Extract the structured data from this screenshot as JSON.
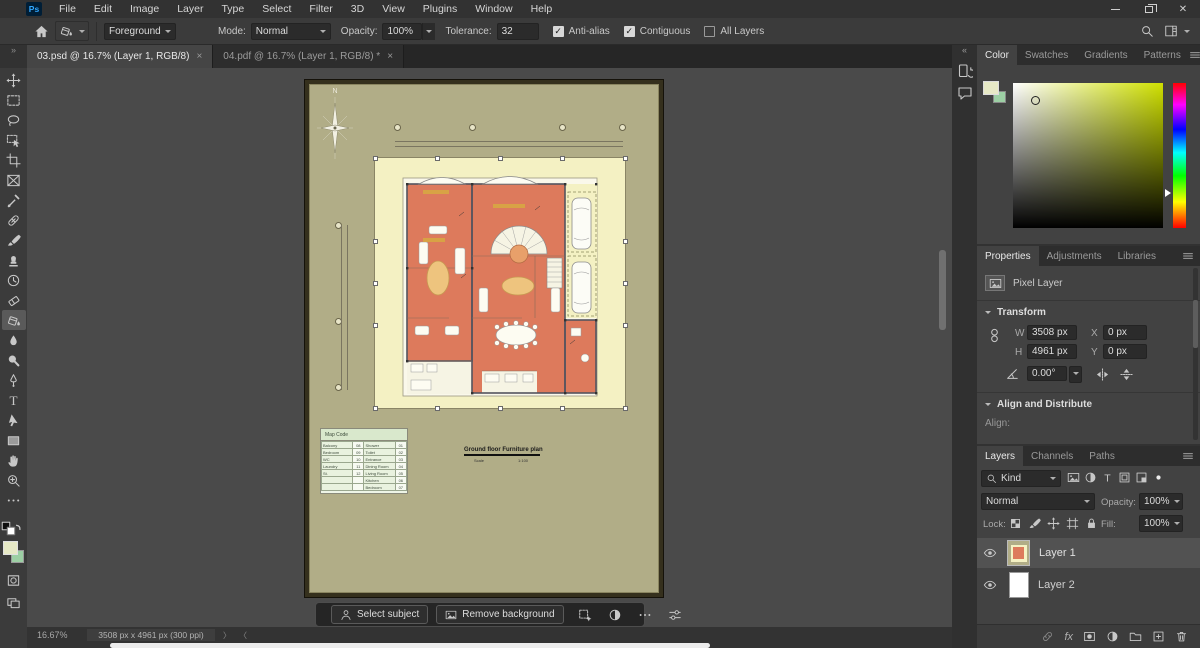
{
  "menu_bar": {
    "logo": "Ps",
    "items": [
      "File",
      "Edit",
      "Image",
      "Layer",
      "Type",
      "Select",
      "Filter",
      "3D",
      "View",
      "Plugins",
      "Window",
      "Help"
    ]
  },
  "window_controls": {
    "close_glyph": "✕"
  },
  "options_bar": {
    "preset_value": "Foreground",
    "mode_label": "Mode:",
    "mode_value": "Normal",
    "opacity_label": "Opacity:",
    "opacity_value": "100%",
    "tolerance_label": "Tolerance:",
    "tolerance_value": "32",
    "check_glyph": "✓",
    "checkboxes": [
      {
        "label": "Anti-alias",
        "checked": true
      },
      {
        "label": "Contiguous",
        "checked": true
      },
      {
        "label": "All Layers",
        "checked": false
      }
    ]
  },
  "tabs": [
    {
      "label": "03.psd @ 16.7% (Layer 1, RGB/8)",
      "close": "×",
      "active": true
    },
    {
      "label": "04.pdf @ 16.7% (Layer 1, RGB/8) *",
      "close": "×",
      "active": false
    }
  ],
  "toolbar": {
    "collapse_glyph": "»",
    "tools": [
      "move",
      "rect-marquee",
      "lasso",
      "object-selection",
      "crop",
      "frame",
      "eyedropper",
      "spot-healing",
      "brush",
      "clone-stamp",
      "history-brush",
      "eraser",
      "paint-bucket",
      "blur",
      "dodge",
      "pen",
      "type",
      "path-selection",
      "rectangle",
      "hand",
      "zoom",
      "edit-toolbar"
    ],
    "selected": "paint-bucket",
    "foreground_color": "#e7e9c6",
    "background_color": "#9ccfa4"
  },
  "document": {
    "compass_label": "N",
    "title": "Ground floor Furniture plan",
    "scale_label": "Scale",
    "scale_value": "1:100",
    "legend": {
      "title": "Map Code",
      "rows": [
        [
          "Balcony",
          "08",
          "Shower",
          "01"
        ],
        [
          "Bedroom",
          "09",
          "Toilet",
          "02"
        ],
        [
          "WC",
          "10",
          "Entrance",
          "03"
        ],
        [
          "Laundry",
          "11",
          "Dining Room",
          "04"
        ],
        [
          "St.",
          "12",
          "Living Room",
          "05"
        ],
        [
          "",
          "",
          "Kitchen",
          "06"
        ],
        [
          "",
          "",
          "Bedroom",
          "07"
        ]
      ]
    },
    "colors": {
      "mat": "#b1ad87",
      "paper": "#f4f1c3",
      "rooms": "#dd7a5c",
      "frame": "#35301d"
    }
  },
  "context_bar": {
    "select_subject": "Select subject",
    "remove_background": "Remove background"
  },
  "dock": {
    "collapse_glyph": "«"
  },
  "panels": {
    "color": {
      "tabs": [
        "Color",
        "Swatches",
        "Gradients",
        "Patterns"
      ],
      "active_tab": "Color"
    },
    "properties": {
      "tabs": [
        "Properties",
        "Adjustments",
        "Libraries"
      ],
      "active_tab": "Properties",
      "layer_type": "Pixel Layer",
      "transform": {
        "header": "Transform",
        "w_label": "W",
        "w_value": "3508 px",
        "x_label": "X",
        "x_value": "0 px",
        "h_label": "H",
        "h_value": "4961 px",
        "y_label": "Y",
        "y_value": "0 px",
        "angle_value": "0.00°"
      },
      "align_header": "Align and Distribute",
      "align_label": "Align:"
    },
    "layers": {
      "tabs": [
        "Layers",
        "Channels",
        "Paths"
      ],
      "active_tab": "Layers",
      "kind_label": "Kind",
      "blend_mode": "Normal",
      "opacity_label": "Opacity:",
      "opacity_value": "100%",
      "lock_label": "Lock:",
      "fill_label": "Fill:",
      "fill_value": "100%",
      "fx_label": "fx",
      "layers": [
        {
          "name": "Layer 1",
          "selected": true,
          "visible": true
        },
        {
          "name": "Layer 2",
          "selected": false,
          "visible": true
        }
      ]
    }
  },
  "status_bar": {
    "zoom": "16.67%",
    "doc_info": "3508 px x 4961 px (300 ppi)",
    "nav_next": "〉",
    "nav_prev": "〈"
  }
}
